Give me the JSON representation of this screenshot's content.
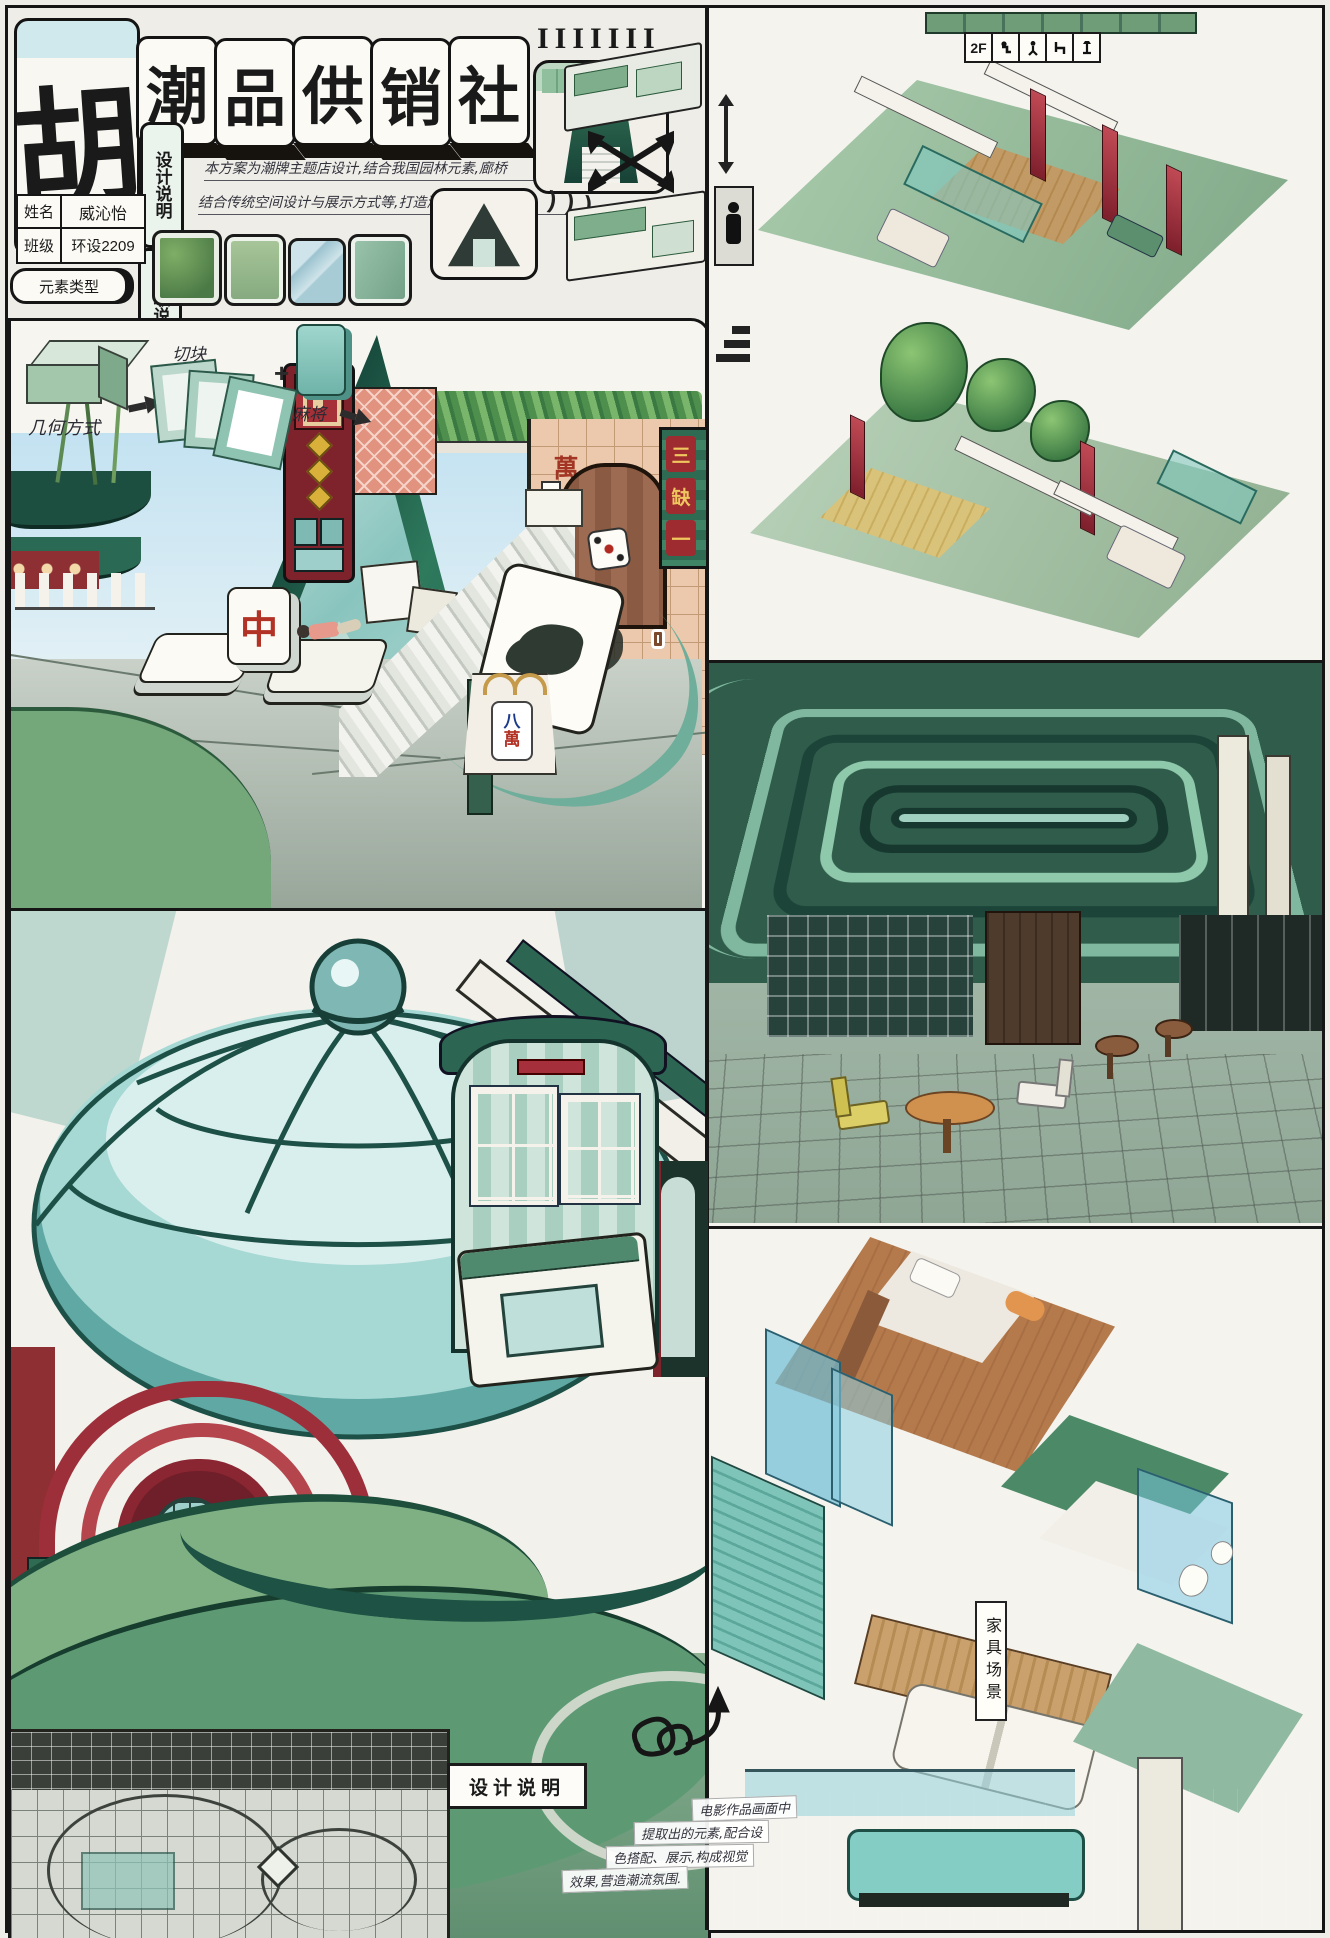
{
  "palette": {
    "paper": "#efede7",
    "ink": "#1a1a1a",
    "deep_green": "#1e5b49",
    "teal": "#7fc4bf",
    "sky_blue": "#c7e4f0",
    "brand_red": "#a62f3c",
    "salmon": "#e79a8b",
    "tan": "#e9c9ae",
    "wood_brown": "#9c6b52",
    "sage": "#9cc0a5"
  },
  "header": {
    "logo_char": "胡",
    "title_chars": [
      "潮",
      "品",
      "供",
      "销",
      "社"
    ],
    "edge_tiles": "IIIIIII",
    "vertical_tile_top": "设计说明",
    "vertical_tile_bottom": "提取说明",
    "intro_line1": "本方案为潮牌主题店设计,结合我国园林元素,廊桥",
    "intro_line2": "结合传统空间设计与展示方式等,打造潮流艺术氛围.",
    "curl_marks": ")))",
    "info": {
      "name_label": "姓名",
      "name_value": "威沁怡",
      "class_label": "班级",
      "class_value": "环设2209"
    },
    "element_type_label": "元素类型"
  },
  "process": {
    "geometry_label": "几何方式",
    "cut_label": "切块",
    "mahjong_label": "麻将",
    "plus_glyph": "+"
  },
  "storefront": {
    "missing_one_sign_chars": [
      "三",
      "缺",
      "一"
    ],
    "tile_wall_chars": [
      "萬",
      "一",
      "五",
      "一",
      "萬"
    ],
    "zhong_tile_char": "中",
    "bag_tile_chars": [
      "八",
      "萬"
    ]
  },
  "design_note": {
    "box_label": "设计说明",
    "lines": [
      "电影作品画面中",
      "提取出的元素,配合设",
      "色搭配、展示,构成视觉",
      "效果,营造潮流氛围."
    ]
  },
  "right_column": {
    "floor_label": "2F",
    "legend_icon_names": [
      "person-seated-icon",
      "person-walking-icon",
      "chair-icon",
      "lamp-icon"
    ],
    "furniture_sign_chars": [
      "家",
      "具",
      "场",
      "景"
    ]
  }
}
